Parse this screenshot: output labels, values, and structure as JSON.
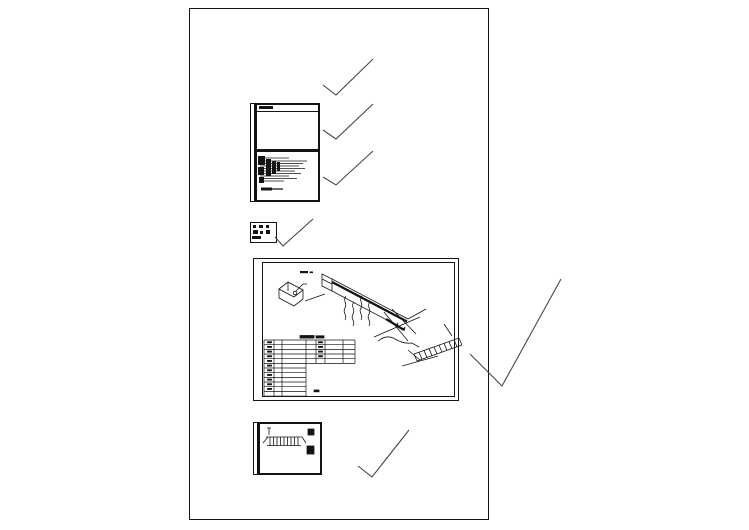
{
  "app": {
    "kind": "cad-drawing-preview",
    "background_color": "#ffffff",
    "ink_color": "#141414",
    "checkmark_color": "#474747"
  },
  "sheet": {
    "x": 189,
    "y": 8,
    "width": 300,
    "height": 512
  },
  "checkmarks": [
    {
      "id": "checkmark-1",
      "points": "323,85 336,95 373,59"
    },
    {
      "id": "checkmark-2",
      "points": "323,130 336,139 373,104"
    },
    {
      "id": "checkmark-3",
      "points": "323,177 336,185 373,151"
    },
    {
      "id": "checkmark-4",
      "points": "275,237 283,246 313,219"
    },
    {
      "id": "checkmark-5",
      "points": "470,354 502,386 561,279"
    },
    {
      "id": "checkmark-6",
      "points": "358,466 372,477 409,430"
    }
  ],
  "riser_schematic": {
    "branch_lines": [
      {
        "y": 6,
        "x2": 32
      },
      {
        "y": 9,
        "x2": 50
      },
      {
        "y": 11.5,
        "x2": 46
      },
      {
        "y": 14,
        "x2": 42
      },
      {
        "y": 16.5,
        "x2": 48
      },
      {
        "y": 19,
        "x2": 38
      },
      {
        "y": 21.5,
        "x2": 44
      },
      {
        "y": 24,
        "x2": 32
      },
      {
        "y": 26.5,
        "x2": 40
      },
      {
        "y": 29,
        "x2": 27
      }
    ],
    "breaker_blobs": [
      [
        1,
        4,
        7,
        9
      ],
      [
        9,
        7,
        5,
        17
      ],
      [
        1,
        15,
        6,
        8
      ],
      [
        15,
        9,
        4,
        13
      ],
      [
        2,
        25,
        5,
        6
      ],
      [
        20,
        10,
        3,
        9
      ]
    ],
    "legend_line": {
      "y": 37,
      "x1": 4,
      "x2": 26
    },
    "legend_blob": [
      4,
      35.5,
      11,
      3
    ],
    "title_blob": [
      2,
      0.5,
      14,
      3.5
    ]
  },
  "legend_box": {
    "marks": [
      [
        2,
        2,
        3,
        2.5
      ],
      [
        8,
        2,
        4,
        2.5
      ],
      [
        15,
        2,
        3,
        2.5
      ],
      [
        2,
        7,
        5,
        4
      ],
      [
        9,
        8,
        3,
        3
      ],
      [
        15,
        7,
        4,
        4
      ],
      [
        1,
        13,
        9,
        3
      ]
    ]
  },
  "iso_drawing": {
    "table": {
      "x": 2,
      "y": 78,
      "row_h": 4.67,
      "rows": 12,
      "left_right": 44,
      "left_cols": [
        12,
        20
      ],
      "right_x2": 93,
      "right_rows": 5,
      "right_cols": [
        54,
        63,
        81
      ],
      "left_dash_rows": 11,
      "right_dash_rows": 4,
      "lone_dash": [
        52,
        128,
        5,
        1.8
      ],
      "title_marks": [
        [
          38,
          73.5,
          14,
          2.6
        ],
        [
          54,
          73.8,
          8,
          2.2
        ]
      ]
    },
    "ladder": {
      "x1": 152,
      "y1": 92,
      "x2": 197,
      "y2": 76,
      "dx": 3,
      "dy": 7,
      "rungs": 8
    }
  },
  "tray_drawing": {
    "ribs": {
      "x1": 10,
      "x2": 38,
      "count": 9,
      "y1": 13,
      "y2": 21.5
    },
    "squares": [
      [
        48,
        5,
        6,
        6
      ],
      [
        47,
        22,
        7,
        8
      ]
    ]
  }
}
